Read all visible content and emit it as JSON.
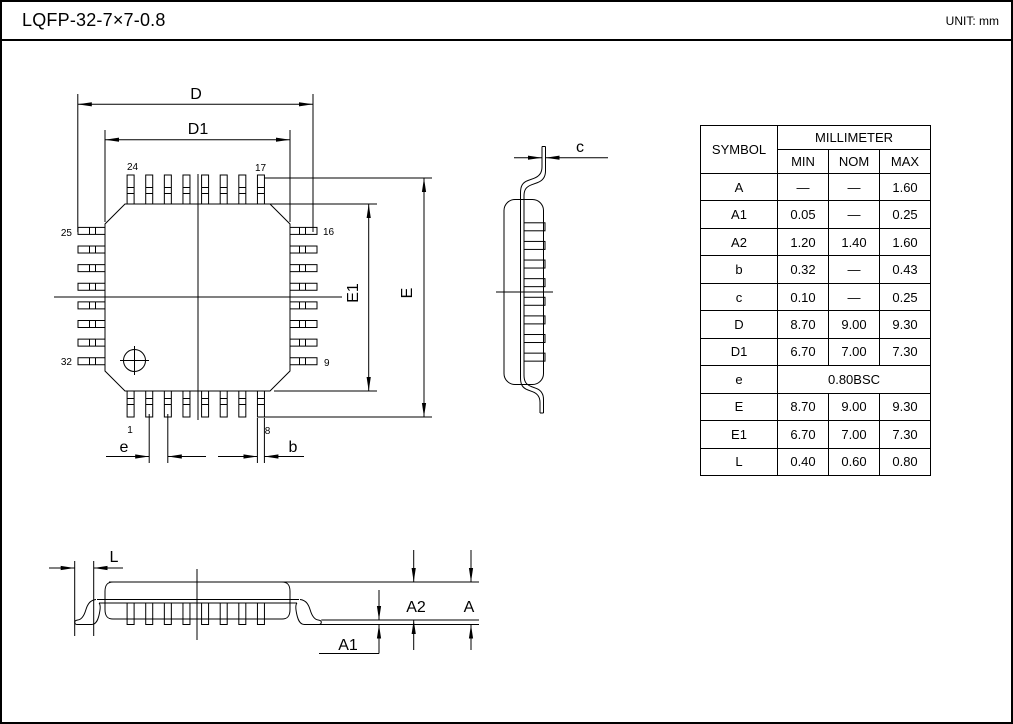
{
  "header": {
    "title": "LQFP-32-7×7-0.8",
    "unit": "UNIT: mm"
  },
  "labels": {
    "d": "D",
    "d1": "D1",
    "e_cap": "E",
    "e1": "E1",
    "e_pitch": "e",
    "b": "b",
    "c": "c",
    "l": "L",
    "a": "A",
    "a1": "A1",
    "a2": "A2"
  },
  "pins": {
    "top_left": "24",
    "top_right": "17",
    "left_top": "25",
    "left_bottom": "32",
    "right_top": "16",
    "right_bottom": "9",
    "bottom_left": "1",
    "bottom_right": "8"
  },
  "table": {
    "col_symbol": "SYMBOL",
    "col_group": "MILLIMETER",
    "col_min": "MIN",
    "col_nom": "NOM",
    "col_max": "MAX",
    "rows": [
      {
        "symbol": "A",
        "min": "—",
        "nom": "—",
        "max": "1.60"
      },
      {
        "symbol": "A1",
        "min": "0.05",
        "nom": "—",
        "max": "0.25"
      },
      {
        "symbol": "A2",
        "min": "1.20",
        "nom": "1.40",
        "max": "1.60"
      },
      {
        "symbol": "b",
        "min": "0.32",
        "nom": "—",
        "max": "0.43"
      },
      {
        "symbol": "c",
        "min": "0.10",
        "nom": "—",
        "max": "0.25"
      },
      {
        "symbol": "D",
        "min": "8.70",
        "nom": "9.00",
        "max": "9.30"
      },
      {
        "symbol": "D1",
        "min": "6.70",
        "nom": "7.00",
        "max": "7.30"
      },
      {
        "symbol": "e",
        "span": "0.80BSC"
      },
      {
        "symbol": "E",
        "min": "8.70",
        "nom": "9.00",
        "max": "9.30"
      },
      {
        "symbol": "E1",
        "min": "6.70",
        "nom": "7.00",
        "max": "7.30"
      },
      {
        "symbol": "L",
        "min": "0.40",
        "nom": "0.60",
        "max": "0.80"
      }
    ]
  }
}
